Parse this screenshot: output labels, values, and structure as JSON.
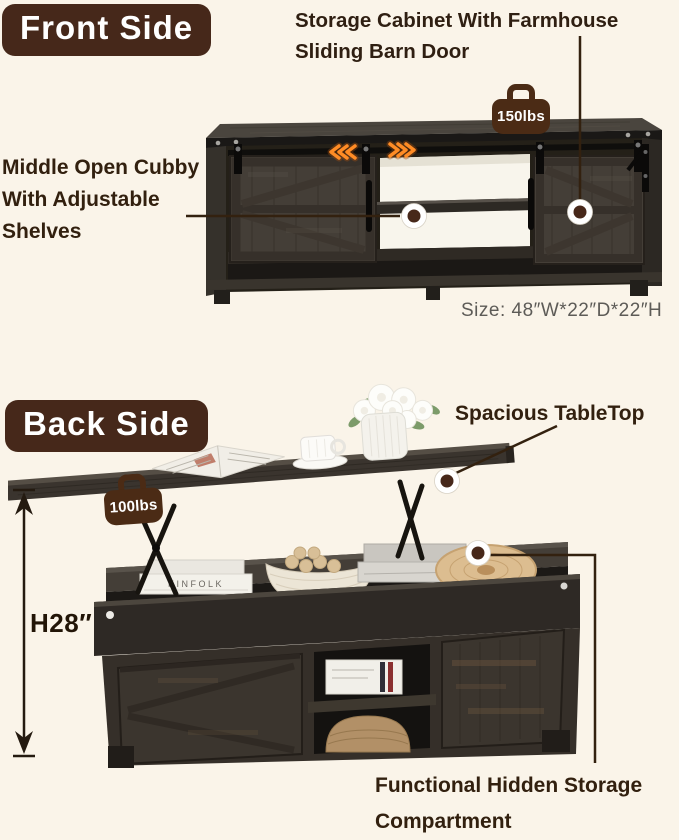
{
  "meta": {
    "background_color": "#FAF4E9",
    "badge_background": "#46281a",
    "badge_text_color": "#ffffff",
    "annotation_text_color": "#32200f",
    "callout_line_color": "#33210f",
    "callout_dot_color": "#47281a",
    "arrow_glow_color": "#ff8c25",
    "size_text_color": "#5d5b57",
    "kettlebell_color": "#4b2b15",
    "icons": [
      "weight-kettlebell-icon",
      "slide-left-chevrons-icon",
      "slide-right-chevrons-icon",
      "height-measure-arrow-icon",
      "callout-dot-icon"
    ]
  },
  "front": {
    "badge_label": "Front Side",
    "heading_line1": "Storage Cabinet With Farmhouse",
    "heading_line2": "Sliding Barn Door",
    "cubby_line1": "Middle Open Cubby",
    "cubby_line2": "With Adjustable",
    "cubby_line3": "Shelves",
    "weight_label": "150lbs",
    "size_label": "Size: 48″W*22″D*22″H"
  },
  "back": {
    "badge_label": "Back Side",
    "tabletop_label": "Spacious TableTop",
    "weight_label": "100lbs",
    "height_label": "H28″",
    "storage_line1": "Functional Hidden Storage",
    "storage_line2": "Compartment",
    "decor_book_title": "KINFOLK"
  }
}
